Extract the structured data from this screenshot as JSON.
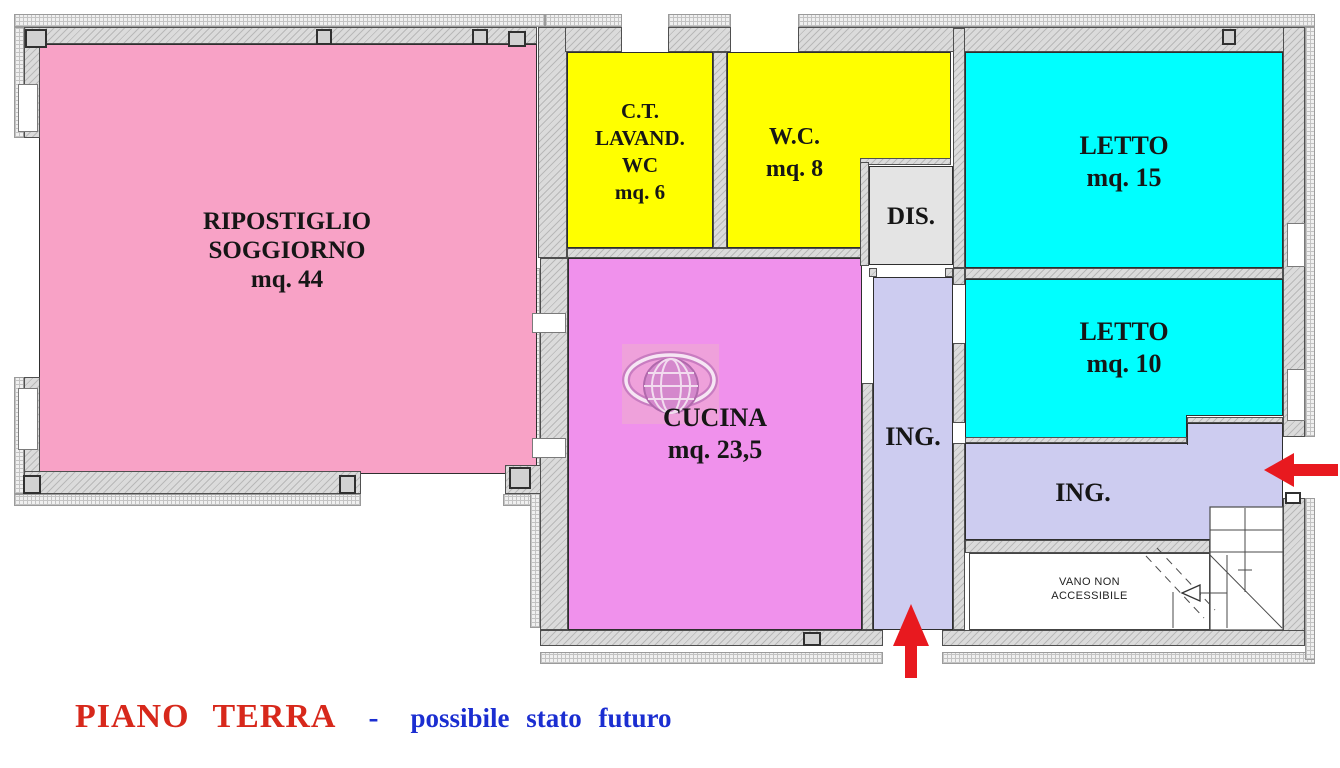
{
  "plan": {
    "caption": {
      "title": "PIANO TERRA",
      "separator": "-",
      "subtitle": "possibile stato futuro",
      "title_color": "#D7281B",
      "subtitle_color": "#1B2ED1"
    },
    "arrow_color": "#E8191F",
    "palette": {
      "wall": "#DBDBDB",
      "outer_band": "#F0F0F0",
      "stair_line": "#4a4a4a"
    },
    "rooms": [
      {
        "id": "ripostiglio-soggiorno",
        "lines": [
          "RIPOSTIGLIO",
          "SOGGIORNO",
          "mq. 44"
        ],
        "color": "#F8A2C6"
      },
      {
        "id": "ct-lavand-wc",
        "lines": [
          "C.T.",
          "LAVAND.",
          "WC",
          "mq. 6"
        ],
        "color": "#FFFF00"
      },
      {
        "id": "wc",
        "lines": [
          "W.C.",
          "mq. 8"
        ],
        "color": "#FFFF00"
      },
      {
        "id": "dis",
        "lines": [
          "DIS."
        ],
        "color": "#E4E4E4"
      },
      {
        "id": "letto-15",
        "lines": [
          "LETTO",
          "mq. 15"
        ],
        "color": "#00FFFF"
      },
      {
        "id": "letto-10",
        "lines": [
          "LETTO",
          "mq. 10"
        ],
        "color": "#00FFFF"
      },
      {
        "id": "cucina",
        "lines": [
          "CUCINA",
          "mq. 23,5"
        ],
        "color": "#F091EC"
      },
      {
        "id": "ing-verticale",
        "lines": [
          "ING."
        ],
        "color": "#CDCCF0"
      },
      {
        "id": "ing-orizzontale",
        "lines": [
          "ING."
        ],
        "color": "#CDCCF0"
      },
      {
        "id": "vano-non-accessibile",
        "lines": [
          "VANO NON",
          "ACCESSIBILE"
        ],
        "color": "#FFFFFF"
      }
    ]
  }
}
